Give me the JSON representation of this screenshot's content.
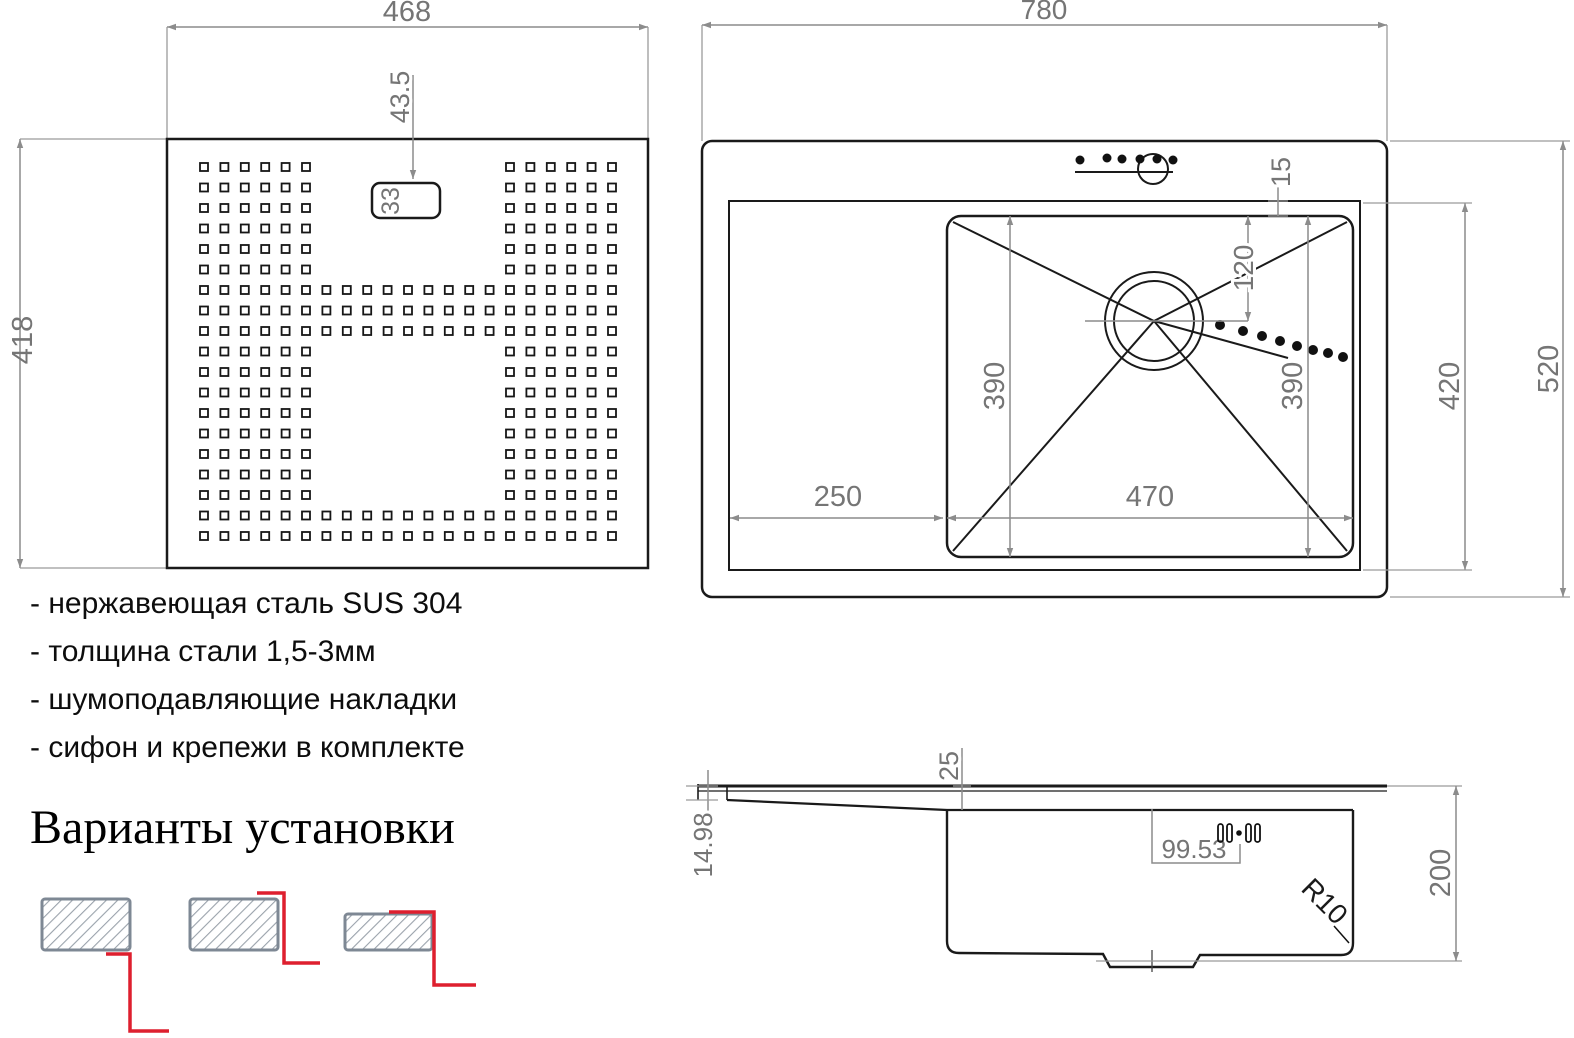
{
  "colors": {
    "line_black": "#1a1a1a",
    "dimension_gray": "#8c8c8c",
    "dim_text_gray": "#757575",
    "accent_red": "#de1f2e",
    "hatch_border_gray": "#7e8894"
  },
  "specs": {
    "items": [
      "- нержавеющая сталь SUS 304",
      "- толщина стали 1,5-3мм",
      "- шумоподавляющие накладки",
      "- сифон и крепежи в комплекте"
    ]
  },
  "install": {
    "title": "Варианты установки"
  },
  "drawings": {
    "plate": {
      "width": "468",
      "height": "418",
      "hole_offset": "43.5",
      "hole_size": "33"
    },
    "top_view": {
      "width": "780",
      "height": "520",
      "inner_height": "420",
      "bowl_width": "470",
      "drainboard_width": "250",
      "bowl_length_left": "390",
      "bowl_length_right": "390",
      "drain_offset": "120",
      "rim_gap": "15"
    },
    "side_view": {
      "rim_height": "14.98",
      "edge_drop": "25",
      "clip_offset": "99.53",
      "depth": "200",
      "corner_radius": "R10"
    }
  }
}
